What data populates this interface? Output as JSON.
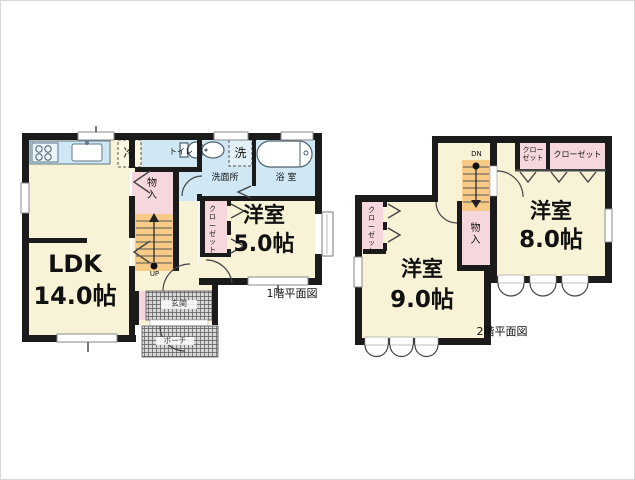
{
  "page": {
    "background": "#ffffff",
    "border_color": "#d9d9d9"
  },
  "colors": {
    "wall": "#1b1b1b",
    "room_cream": "#f8f2d7",
    "wet_blue": "#cfe8f3",
    "closet_pink": "#f6d7dd",
    "stairs_orange": "#f7ca85",
    "hatch_gray": "#d7d7d7",
    "window_white": "#ffffff",
    "line_gray": "#444444"
  },
  "floor1": {
    "caption": "1階平面図",
    "ldk": {
      "name": "LDK",
      "size": "14.0帖"
    },
    "western_room": {
      "name": "洋室",
      "size": "5.0帖"
    },
    "labels": {
      "fridge": "冷",
      "toilet": "トイレ",
      "washer": "洗",
      "washroom": "洗面所",
      "bath": "浴 室",
      "storage": "物入",
      "closet": "クローゼット",
      "stairs": "UP",
      "entrance": "玄関",
      "porch": "ポーチ"
    }
  },
  "floor2": {
    "caption": "2階平面図",
    "western_room_9": {
      "name": "洋室",
      "size": "9.0帖"
    },
    "western_room_8": {
      "name": "洋室",
      "size": "8.0帖"
    },
    "labels": {
      "closet_small": "クローゼット",
      "closet_wide": "クローゼット",
      "closet_left": "クローゼット",
      "storage": "物入",
      "stairs": "DN"
    }
  }
}
